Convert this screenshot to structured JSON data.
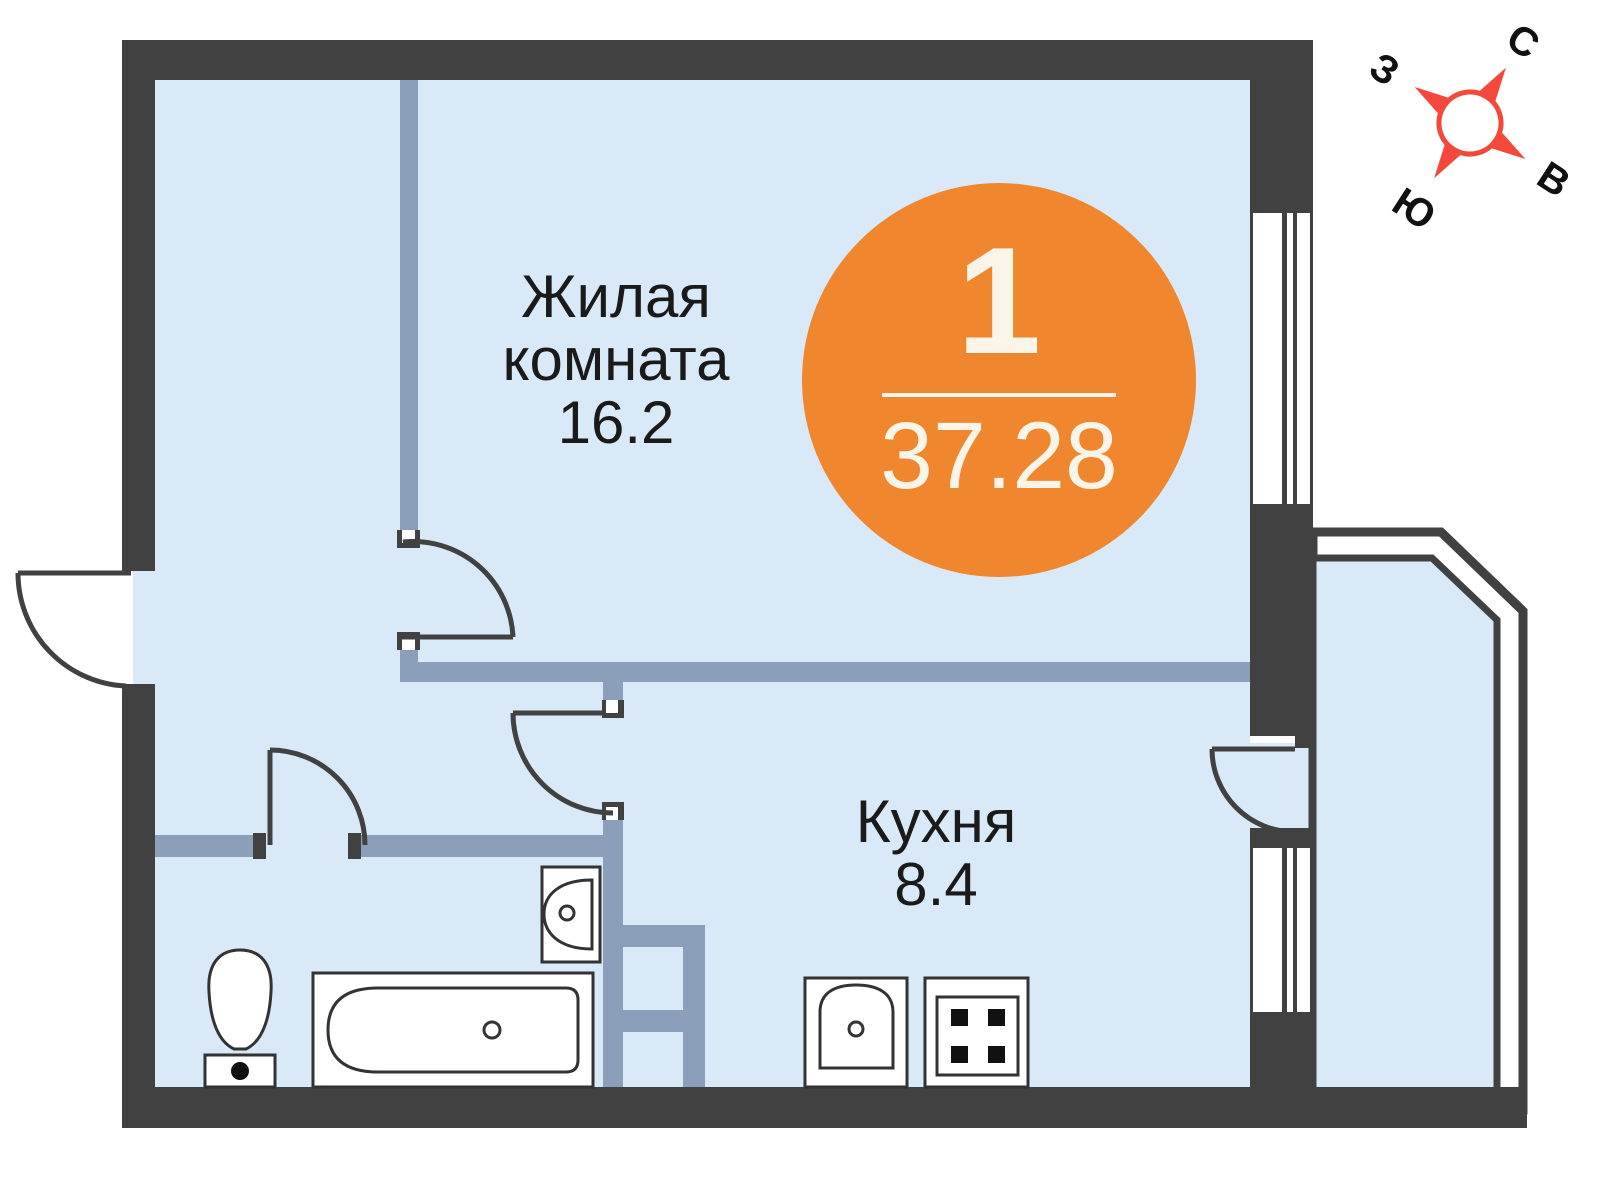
{
  "plan": {
    "unit_badge": {
      "rooms": "1",
      "total_area": "37.28"
    },
    "rooms": {
      "living": {
        "name_line1": "Жилая",
        "name_line2": "комната",
        "area": "16.2"
      },
      "kitchen": {
        "name": "Кухня",
        "area": "8.4"
      }
    },
    "compass": {
      "north": "С",
      "east": "В",
      "south": "Ю",
      "west": "З"
    }
  },
  "colors": {
    "wall": "#414141",
    "partition": "#8B9FBB",
    "floor": "#DAE9F7",
    "fixture_line": "#333333",
    "accent": "#F0862D",
    "badge_text": "#FBF5E9",
    "compass_red": "#F4483B",
    "label": "#1A1A1A"
  }
}
